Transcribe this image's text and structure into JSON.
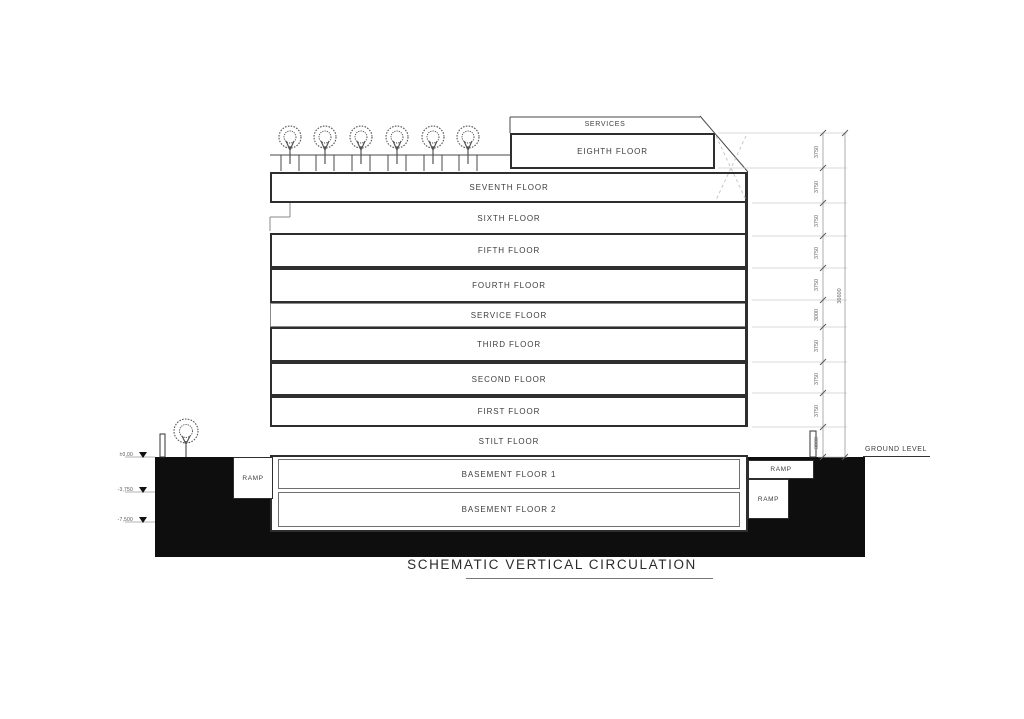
{
  "title": "SCHEMATIC VERTICAL CIRCULATION",
  "floors": [
    {
      "label": "SERVICES"
    },
    {
      "label": "EIGHTH FLOOR"
    },
    {
      "label": "SEVENTH FLOOR"
    },
    {
      "label": "SIXTH FLOOR"
    },
    {
      "label": "FIFTH FLOOR"
    },
    {
      "label": "FOURTH FLOOR"
    },
    {
      "label": "SERVICE FLOOR"
    },
    {
      "label": "THIRD FLOOR"
    },
    {
      "label": "SECOND FLOOR"
    },
    {
      "label": "FIRST FLOOR"
    },
    {
      "label": "STILT FLOOR"
    },
    {
      "label": "BASEMENT FLOOR 1"
    },
    {
      "label": "BASEMENT FLOOR 2"
    }
  ],
  "ramps": {
    "left": "RAMP",
    "right_upper": "RAMP",
    "right_lower": "RAMP"
  },
  "annotations": {
    "ground_level": "GROUND LEVEL"
  },
  "levels": [
    {
      "label": "±0.00"
    },
    {
      "label": "-3,750"
    },
    {
      "label": "-7,500"
    }
  ],
  "dimensions": {
    "segments": [
      "3750",
      "3750",
      "3750",
      "3750",
      "3750",
      "3000",
      "3750",
      "3750",
      "3750",
      "3000"
    ],
    "overall": "36600"
  },
  "colors": {
    "line": "#2e2e2e",
    "ground_fill": "#0e0e0e",
    "dim_line": "#9a9a9a"
  }
}
